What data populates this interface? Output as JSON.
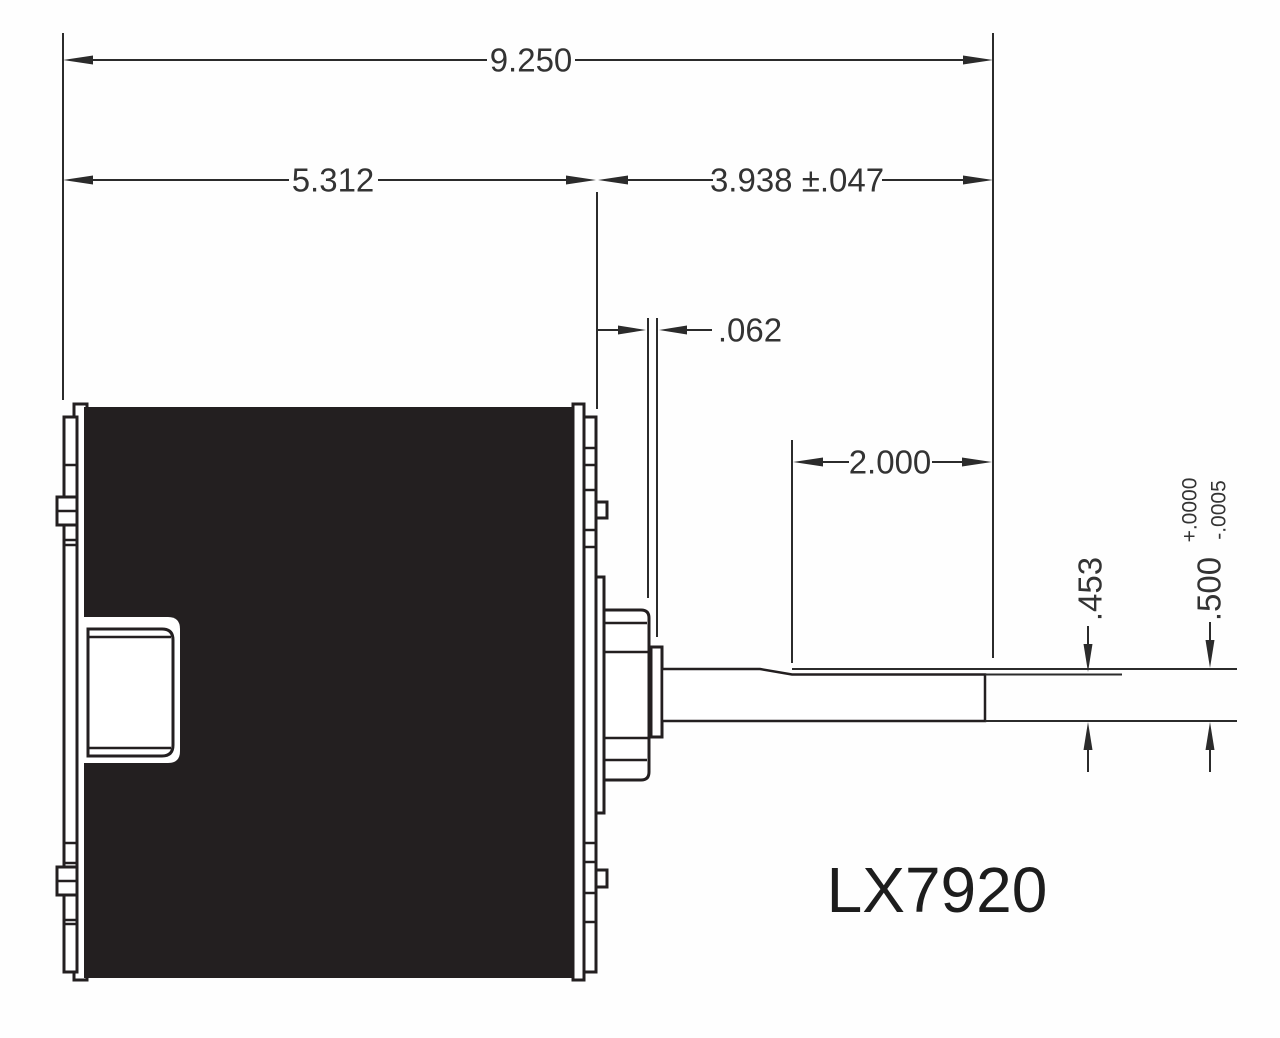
{
  "drawing": {
    "part_number": "LX7920",
    "dimensions": {
      "overall_length": "9.250",
      "body_length": "5.312",
      "shaft_extension": "3.938 ±.047",
      "slinger_thickness": ".062",
      "flat_length": "2.000",
      "flat_height": ".453",
      "shaft_diameter": ".500",
      "shaft_dia_tol_plus": "+.0000",
      "shaft_dia_tol_minus": "-.0005"
    },
    "colors": {
      "line": "#231f20",
      "body_fill": "#231f20",
      "background": "#ffffff",
      "text": "#333333"
    }
  }
}
